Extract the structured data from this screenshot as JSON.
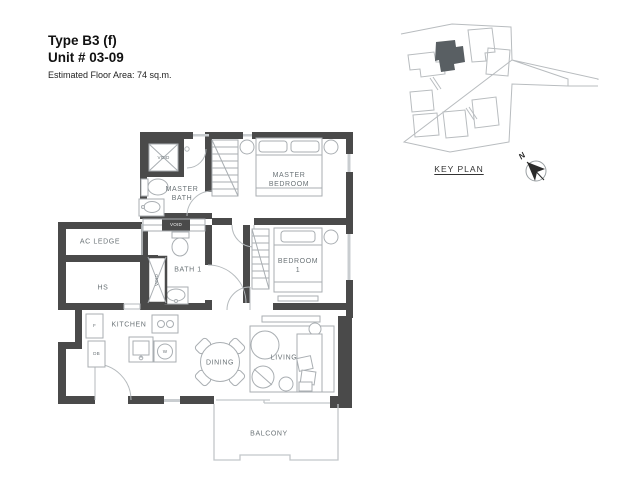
{
  "header": {
    "type_label": "Type B3 (f)",
    "unit_label": "Unit # 03-09",
    "area_label": "Estimated Floor Area: 74 sq.m."
  },
  "key_plan": {
    "title": "KEY PLAN",
    "north_label": "N"
  },
  "rooms": {
    "master_bath": "MASTER\nBATH",
    "master_bedroom": "MASTER\nBEDROOM",
    "ac_ledge": "AC LEDGE",
    "hs": "HS",
    "bath_1": "BATH 1",
    "bedroom_1": "BEDROOM\n1",
    "kitchen": "KITCHEN",
    "dining": "DINING",
    "living": "LIVING",
    "balcony": "BALCONY"
  },
  "annotations": {
    "void_shower": "VOID",
    "void_shaft": "VOID",
    "void_strip": "VOID",
    "fridge": "F",
    "distribution_board": "DB",
    "washer": "W"
  },
  "colors": {
    "wall": "#4a4a4a",
    "furniture_line": "#a9aeb2",
    "window_line": "#c9cdd0",
    "label_text": "#6b7377",
    "keyplan_highlight": "#595f63"
  }
}
